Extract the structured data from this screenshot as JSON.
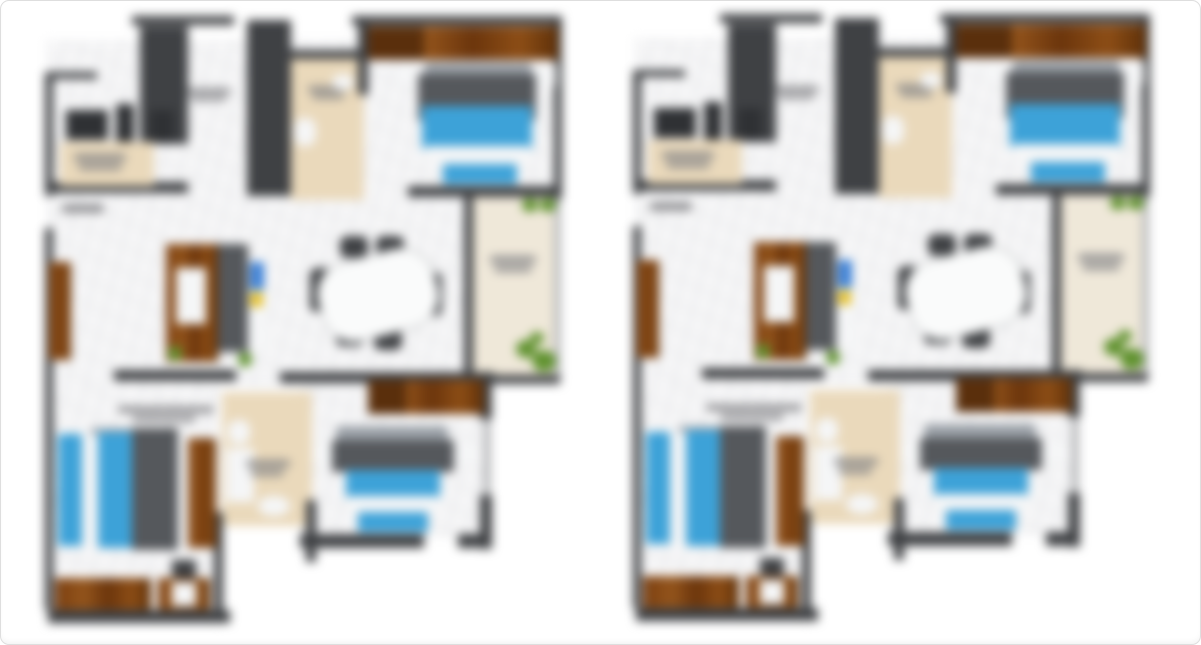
{
  "page": {
    "background": "#ffffff",
    "frame_border_color": "#dedede",
    "description": "Two identical blurred apartment floor plans displayed side by side on a white page; all room label text is blurred beyond legibility"
  },
  "colors": {
    "wall": "#3f4144",
    "wallLight": "#b9babc",
    "wood": "#8a4a16",
    "woodDark": "#5a2f0c",
    "bedBlue": "#3da2d8",
    "bedDark": "#55585c",
    "pillow": "#9aa0a7",
    "white": "#f5f6f7",
    "beige": "#ead9bb",
    "beigeLight": "#efe8d9",
    "plant": "#60922f",
    "textBlob": "#7f7f82",
    "accentBlue": "#3a7fd5",
    "accentYellow": "#e5c12e",
    "appliance": "#2f3134",
    "tableWhite": "#fafbfb",
    "floor": "#f6f6f7"
  },
  "plans": [
    {
      "name": "floor-plan-left",
      "x": 40,
      "y": 14,
      "w": 525,
      "h": 612
    },
    {
      "name": "floor-plan-right",
      "x": 628,
      "y": 12,
      "w": 525,
      "h": 612
    }
  ],
  "elements": [
    {
      "n": "floor-main",
      "x": 6,
      "y": 26,
      "w": 432,
      "h": 348,
      "c": "floor"
    },
    {
      "n": "floor-bedroom-top-right",
      "x": 326,
      "y": 12,
      "w": 194,
      "h": 172,
      "c": "floor"
    },
    {
      "n": "floor-bedroom-bottom-left",
      "x": 8,
      "y": 372,
      "w": 172,
      "h": 238,
      "c": "floor"
    },
    {
      "n": "floor-bedroom-bottom-right",
      "x": 258,
      "y": 374,
      "w": 188,
      "h": 150,
      "c": "floor"
    },
    {
      "n": "floor-bathroom-top",
      "x": 250,
      "y": 44,
      "w": 74,
      "h": 142,
      "c": "beige"
    },
    {
      "n": "floor-bathroom-bottom",
      "x": 182,
      "y": 378,
      "w": 90,
      "h": 134,
      "c": "beige"
    },
    {
      "n": "floor-balcony",
      "x": 432,
      "y": 183,
      "w": 84,
      "h": 180,
      "c": "beigeLight"
    },
    {
      "n": "wall-kitchen-left",
      "x": 5,
      "y": 58,
      "w": 8,
      "h": 124,
      "c": "wall"
    },
    {
      "n": "wall-kitchen-top",
      "x": 5,
      "y": 58,
      "w": 52,
      "h": 7,
      "c": "wall"
    },
    {
      "n": "wall-kitchen-bottom",
      "x": 8,
      "y": 168,
      "w": 140,
      "h": 11,
      "c": "wall"
    },
    {
      "n": "wall-top-left-band",
      "x": 92,
      "y": 2,
      "w": 102,
      "h": 9,
      "c": "wall"
    },
    {
      "n": "wardrobe-column-a",
      "x": 100,
      "y": 12,
      "w": 48,
      "h": 118,
      "c": "wall"
    },
    {
      "n": "wardrobe-column-b",
      "x": 207,
      "y": 6,
      "w": 44,
      "h": 176,
      "c": "wall"
    },
    {
      "n": "wall-bathroom-top",
      "x": 250,
      "y": 36,
      "w": 74,
      "h": 9,
      "c": "wall"
    },
    {
      "n": "wall-bedroom-tr-left",
      "x": 318,
      "y": 9,
      "w": 10,
      "h": 72,
      "c": "wall"
    },
    {
      "n": "wall-top-right-band",
      "x": 312,
      "y": 2,
      "w": 210,
      "h": 9,
      "c": "wall"
    },
    {
      "n": "wall-right-upper",
      "x": 514,
      "y": 9,
      "w": 8,
      "h": 176,
      "c": "wall"
    },
    {
      "n": "wall-bedroom-tr-bottom",
      "x": 368,
      "y": 172,
      "w": 152,
      "h": 11,
      "c": "wall"
    },
    {
      "n": "wall-balcony-left",
      "x": 424,
      "y": 181,
      "w": 9,
      "h": 192,
      "c": "wall"
    },
    {
      "n": "wall-balcony-right",
      "x": 514,
      "y": 185,
      "w": 7,
      "h": 180,
      "c": "wallLight"
    },
    {
      "n": "wall-balcony-bottom",
      "x": 428,
      "y": 361,
      "w": 92,
      "h": 9,
      "c": "wall"
    },
    {
      "n": "wall-left-middle",
      "x": 5,
      "y": 214,
      "w": 8,
      "h": 164,
      "c": "wall"
    },
    {
      "n": "wall-middle-left",
      "x": 74,
      "y": 356,
      "w": 122,
      "h": 11,
      "c": "wall"
    },
    {
      "n": "wall-middle-right",
      "x": 240,
      "y": 358,
      "w": 214,
      "h": 11,
      "c": "wall"
    },
    {
      "n": "wall-left-lower",
      "x": 5,
      "y": 364,
      "w": 8,
      "h": 232,
      "c": "wall"
    },
    {
      "n": "wall-bottom-left",
      "x": 8,
      "y": 596,
      "w": 182,
      "h": 13,
      "c": "wall"
    },
    {
      "n": "wall-bedroom-bl-right",
      "x": 174,
      "y": 498,
      "w": 9,
      "h": 100,
      "c": "wall"
    },
    {
      "n": "wall-bathroom-bottom-right",
      "x": 266,
      "y": 486,
      "w": 10,
      "h": 62,
      "c": "wall"
    },
    {
      "n": "wall-bedroom-br-right-upper",
      "x": 440,
      "y": 363,
      "w": 12,
      "h": 42,
      "c": "wall"
    },
    {
      "n": "window-bedroom-br",
      "x": 443,
      "y": 405,
      "w": 8,
      "h": 76,
      "c": "wallLight"
    },
    {
      "n": "wall-bedroom-br-right-lower",
      "x": 440,
      "y": 481,
      "w": 12,
      "h": 54,
      "c": "wall"
    },
    {
      "n": "wall-bedroom-br-bottom",
      "x": 260,
      "y": 520,
      "w": 124,
      "h": 14,
      "c": "wall"
    },
    {
      "n": "wall-bedroom-br-bottom-stub",
      "x": 418,
      "y": 520,
      "w": 34,
      "h": 14,
      "c": "wall"
    },
    {
      "n": "kitchen-appliance-1",
      "x": 26,
      "y": 96,
      "w": 42,
      "h": 30,
      "c": "appliance"
    },
    {
      "n": "kitchen-appliance-2",
      "x": 76,
      "y": 90,
      "w": 18,
      "h": 40,
      "c": "appliance"
    },
    {
      "n": "kitchen-appliance-3",
      "x": 110,
      "y": 96,
      "w": 24,
      "h": 32,
      "c": "appliance"
    },
    {
      "n": "kitchen-counter",
      "x": 20,
      "y": 128,
      "w": 94,
      "h": 44,
      "c": "beige"
    },
    {
      "n": "kitchen-label-blob-1",
      "x": 34,
      "y": 140,
      "w": 52,
      "h": 7,
      "c": "textBlob"
    },
    {
      "n": "kitchen-label-blob-2",
      "x": 38,
      "y": 150,
      "w": 44,
      "h": 6,
      "c": "textBlob"
    },
    {
      "n": "entry-label-blob",
      "x": 22,
      "y": 190,
      "w": 42,
      "h": 9,
      "c": "textBlob"
    },
    {
      "n": "hall-label-blob-1",
      "x": 147,
      "y": 74,
      "w": 44,
      "h": 6,
      "c": "textBlob"
    },
    {
      "n": "hall-label-blob-2",
      "x": 151,
      "y": 82,
      "w": 36,
      "h": 5,
      "c": "textBlob"
    },
    {
      "n": "bath-top-label-blob-1",
      "x": 268,
      "y": 72,
      "w": 40,
      "h": 6,
      "c": "textBlob"
    },
    {
      "n": "bath-top-label-blob-2",
      "x": 272,
      "y": 80,
      "w": 32,
      "h": 5,
      "c": "textBlob"
    },
    {
      "n": "bath-top-toilet",
      "x": 254,
      "y": 104,
      "w": 22,
      "h": 28,
      "c": "white",
      "r": "40%"
    },
    {
      "n": "bath-top-sink",
      "x": 292,
      "y": 60,
      "w": 22,
      "h": 16,
      "c": "white",
      "r": "50%"
    },
    {
      "n": "wardrobe-tr",
      "x": 328,
      "y": 12,
      "w": 190,
      "h": 34,
      "c": "wood"
    },
    {
      "n": "wardrobe-tr-dark",
      "x": 328,
      "y": 12,
      "w": 56,
      "h": 34,
      "c": "woodDark"
    },
    {
      "n": "nightstand-tr-left",
      "x": 356,
      "y": 50,
      "w": 20,
      "h": 20,
      "c": "white"
    },
    {
      "n": "nightstand-tr-right",
      "x": 494,
      "y": 50,
      "w": 22,
      "h": 22,
      "c": "white"
    },
    {
      "n": "bed-tr-pillows",
      "x": 384,
      "y": 48,
      "w": 108,
      "h": 18,
      "c": "pillow",
      "r": "4px"
    },
    {
      "n": "bed-tr-headboard",
      "x": 378,
      "y": 60,
      "w": 118,
      "h": 46,
      "c": "bedDark"
    },
    {
      "n": "bed-tr-blanket",
      "x": 382,
      "y": 92,
      "w": 110,
      "h": 44,
      "c": "bedBlue"
    },
    {
      "n": "bed-tr-sheet",
      "x": 385,
      "y": 132,
      "w": 105,
      "h": 20,
      "c": "white"
    },
    {
      "n": "bed-tr-runner",
      "x": 403,
      "y": 150,
      "w": 74,
      "h": 20,
      "c": "bedBlue"
    },
    {
      "n": "balcony-plant-top-1",
      "x": 482,
      "y": 184,
      "w": 16,
      "h": 14,
      "c": "plant"
    },
    {
      "n": "balcony-plant-top-2",
      "x": 500,
      "y": 184,
      "w": 16,
      "h": 14,
      "c": "plant"
    },
    {
      "n": "balcony-label-blob-1",
      "x": 450,
      "y": 242,
      "w": 46,
      "h": 7,
      "c": "textBlob"
    },
    {
      "n": "balcony-label-blob-2",
      "x": 454,
      "y": 252,
      "w": 38,
      "h": 6,
      "c": "textBlob"
    },
    {
      "n": "balcony-plant-bottom-1",
      "x": 476,
      "y": 326,
      "w": 20,
      "h": 18,
      "c": "plant"
    },
    {
      "n": "balcony-plant-bottom-2",
      "x": 492,
      "y": 336,
      "w": 24,
      "h": 22,
      "c": "plant"
    },
    {
      "n": "balcony-plant-bottom-3",
      "x": 490,
      "y": 318,
      "w": 14,
      "h": 12,
      "c": "plant"
    },
    {
      "n": "console-left",
      "x": 9,
      "y": 248,
      "w": 22,
      "h": 98,
      "c": "wood"
    },
    {
      "n": "tv-unit-wood",
      "x": 126,
      "y": 230,
      "w": 52,
      "h": 118,
      "c": "wood"
    },
    {
      "n": "tv-unit-inner",
      "x": 136,
      "y": 254,
      "w": 30,
      "h": 56,
      "c": "white"
    },
    {
      "n": "tv-unit-gray",
      "x": 178,
      "y": 230,
      "w": 30,
      "h": 108,
      "c": "bedDark"
    },
    {
      "n": "tv-shelf",
      "x": 208,
      "y": 244,
      "w": 20,
      "h": 90,
      "c": "white"
    },
    {
      "n": "shelf-item-blue",
      "x": 210,
      "y": 248,
      "w": 14,
      "h": 28,
      "c": "accentBlue"
    },
    {
      "n": "shelf-item-yellow",
      "x": 210,
      "y": 278,
      "w": 13,
      "h": 15,
      "c": "accentYellow"
    },
    {
      "n": "plant-small-1",
      "x": 128,
      "y": 332,
      "w": 14,
      "h": 15,
      "c": "plant"
    },
    {
      "n": "plant-small-2",
      "x": 198,
      "y": 338,
      "w": 14,
      "h": 15,
      "c": "plant"
    },
    {
      "n": "dining-chair-top-1",
      "x": 300,
      "y": 222,
      "w": 28,
      "h": 22,
      "c": "wall",
      "r": "7px"
    },
    {
      "n": "dining-chair-top-2",
      "x": 336,
      "y": 222,
      "w": 28,
      "h": 22,
      "c": "wall",
      "r": "7px"
    },
    {
      "n": "dining-chair-left",
      "x": 270,
      "y": 254,
      "w": 22,
      "h": 44,
      "c": "wall",
      "r": "7px"
    },
    {
      "n": "dining-chair-right",
      "x": 380,
      "y": 258,
      "w": 22,
      "h": 44,
      "c": "wall",
      "r": "7px"
    },
    {
      "n": "dining-chair-bottom-1",
      "x": 296,
      "y": 308,
      "w": 28,
      "h": 24,
      "c": "wall",
      "r": "7px"
    },
    {
      "n": "dining-chair-bottom-2",
      "x": 334,
      "y": 314,
      "w": 28,
      "h": 22,
      "c": "wall",
      "r": "7px"
    },
    {
      "n": "dining-table",
      "x": 278,
      "y": 240,
      "w": 116,
      "h": 78,
      "c": "tableWhite",
      "r": "34px",
      "rot": -14
    },
    {
      "n": "bedroom-bl-label-blob-1",
      "x": 78,
      "y": 392,
      "w": 96,
      "h": 7,
      "c": "textBlob"
    },
    {
      "n": "bedroom-bl-label-blob-2",
      "x": 92,
      "y": 402,
      "w": 64,
      "h": 6,
      "c": "textBlob"
    },
    {
      "n": "bed-bl-pillows",
      "x": 50,
      "y": 414,
      "w": 88,
      "h": 18,
      "c": "pillow",
      "r": "4px"
    },
    {
      "n": "bed-bl-blue-1",
      "x": 18,
      "y": 420,
      "w": 24,
      "h": 112,
      "c": "bedBlue"
    },
    {
      "n": "bed-bl-white-gap",
      "x": 42,
      "y": 420,
      "w": 16,
      "h": 112,
      "c": "white"
    },
    {
      "n": "bed-bl-blue-2",
      "x": 58,
      "y": 418,
      "w": 34,
      "h": 116,
      "c": "bedBlue"
    },
    {
      "n": "bed-bl-blanket",
      "x": 92,
      "y": 414,
      "w": 46,
      "h": 122,
      "c": "bedDark"
    },
    {
      "n": "bed-bl-white-edge",
      "x": 138,
      "y": 420,
      "w": 16,
      "h": 112,
      "c": "white"
    },
    {
      "n": "wardrobe-bl",
      "x": 148,
      "y": 424,
      "w": 28,
      "h": 110,
      "c": "wood"
    },
    {
      "n": "dresser-1",
      "x": 15,
      "y": 564,
      "w": 96,
      "h": 32,
      "c": "wood"
    },
    {
      "n": "dresser-2",
      "x": 118,
      "y": 564,
      "w": 52,
      "h": 32,
      "c": "wood"
    },
    {
      "n": "dresser-2-inset",
      "x": 132,
      "y": 568,
      "w": 24,
      "h": 24,
      "c": "white"
    },
    {
      "n": "dresser-item-dark",
      "x": 132,
      "y": 546,
      "w": 24,
      "h": 18,
      "c": "wall"
    },
    {
      "n": "bath-bottom-shower",
      "x": 186,
      "y": 434,
      "w": 28,
      "h": 54,
      "c": "white"
    },
    {
      "n": "bath-bottom-sink",
      "x": 218,
      "y": 482,
      "w": 32,
      "h": 20,
      "c": "white",
      "r": "50%"
    },
    {
      "n": "bath-bottom-toilet",
      "x": 188,
      "y": 406,
      "w": 22,
      "h": 24,
      "c": "white",
      "r": "40%"
    },
    {
      "n": "bath-bottom-label-blob-1",
      "x": 206,
      "y": 446,
      "w": 44,
      "h": 7,
      "c": "textBlob"
    },
    {
      "n": "bath-bottom-label-blob-2",
      "x": 210,
      "y": 456,
      "w": 34,
      "h": 6,
      "c": "textBlob"
    },
    {
      "n": "wardrobe-br",
      "x": 328,
      "y": 366,
      "w": 116,
      "h": 34,
      "c": "wood"
    },
    {
      "n": "wardrobe-br-dark",
      "x": 328,
      "y": 366,
      "w": 38,
      "h": 34,
      "c": "woodDark"
    },
    {
      "n": "nightstand-br-left",
      "x": 276,
      "y": 428,
      "w": 18,
      "h": 20,
      "c": "white"
    },
    {
      "n": "nightstand-br-right",
      "x": 416,
      "y": 428,
      "w": 20,
      "h": 22,
      "c": "white"
    },
    {
      "n": "bed-br-pillows",
      "x": 296,
      "y": 412,
      "w": 112,
      "h": 20,
      "c": "pillow",
      "r": "4px"
    },
    {
      "n": "bed-br-headboard",
      "x": 292,
      "y": 426,
      "w": 122,
      "h": 32,
      "c": "bedDark"
    },
    {
      "n": "bed-br-blanket",
      "x": 306,
      "y": 456,
      "w": 94,
      "h": 28,
      "c": "bedBlue"
    },
    {
      "n": "bed-br-sheet",
      "x": 308,
      "y": 482,
      "w": 90,
      "h": 18,
      "c": "white"
    },
    {
      "n": "bed-br-runner",
      "x": 318,
      "y": 498,
      "w": 70,
      "h": 20,
      "c": "bedBlue"
    }
  ]
}
